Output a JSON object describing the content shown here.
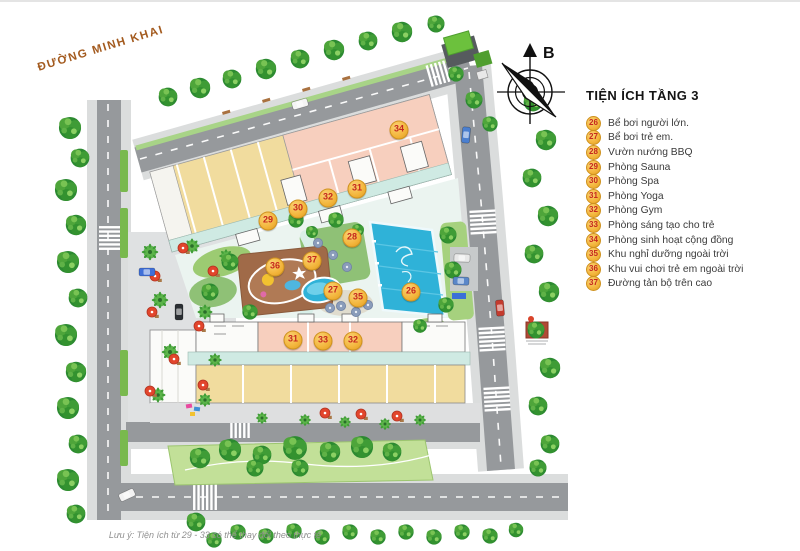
{
  "map": {
    "street_label": "ĐƯỜNG MINH KHAI",
    "compass_label": "B",
    "badges": [
      {
        "number": "34",
        "x": 399,
        "y": 130
      },
      {
        "number": "31",
        "x": 357,
        "y": 189
      },
      {
        "number": "32",
        "x": 328,
        "y": 198
      },
      {
        "number": "30",
        "x": 298,
        "y": 209
      },
      {
        "number": "29",
        "x": 268,
        "y": 221
      },
      {
        "number": "28",
        "x": 352,
        "y": 238
      },
      {
        "number": "37",
        "x": 312,
        "y": 261
      },
      {
        "number": "36",
        "x": 275,
        "y": 267
      },
      {
        "number": "27",
        "x": 333,
        "y": 291
      },
      {
        "number": "35",
        "x": 358,
        "y": 298
      },
      {
        "number": "26",
        "x": 411,
        "y": 292
      },
      {
        "number": "31",
        "x": 293,
        "y": 340
      },
      {
        "number": "33",
        "x": 323,
        "y": 341
      },
      {
        "number": "32",
        "x": 353,
        "y": 341
      }
    ]
  },
  "legend": {
    "title": "TIỆN ÍCH TẦNG 3",
    "items": [
      {
        "number": "26",
        "label": "Bể bơi người lớn."
      },
      {
        "number": "27",
        "label": "Bể bơi trẻ em."
      },
      {
        "number": "28",
        "label": "Vườn nướng BBQ"
      },
      {
        "number": "29",
        "label": "Phòng Sauna"
      },
      {
        "number": "30",
        "label": "Phòng Spa"
      },
      {
        "number": "31",
        "label": "Phòng Yoga"
      },
      {
        "number": "32",
        "label": "Phòng Gym"
      },
      {
        "number": "33",
        "label": "Phòng sáng tạo cho trẻ"
      },
      {
        "number": "34",
        "label": "Phòng sinh hoạt cộng đồng"
      },
      {
        "number": "35",
        "label": "Khu nghỉ dưỡng ngoài trời"
      },
      {
        "number": "36",
        "label": "Khu vui chơi trẻ em ngoài trời"
      },
      {
        "number": "37",
        "label": "Đường tản bộ trên cao"
      }
    ]
  },
  "footer": {
    "note": "Lưu ý: Tiện ích từ 29 - 33 có thể thay đổi theo thực tế"
  },
  "colors": {
    "badge_fill": "#f3b53b",
    "badge_border": "#cf921f",
    "badge_text": "#c5271d",
    "street_label": "#a35a1e",
    "building_yellow": "#f1dc9e",
    "building_pink": "#f7cfbe",
    "corridor_mint": "#cfeae3",
    "pool_blue": "#2fb2d8",
    "road_gray": "#96999c",
    "sidewalk_gray": "#dbdddd",
    "tree_green": "#3e9b3c",
    "note_gray": "#909090"
  }
}
